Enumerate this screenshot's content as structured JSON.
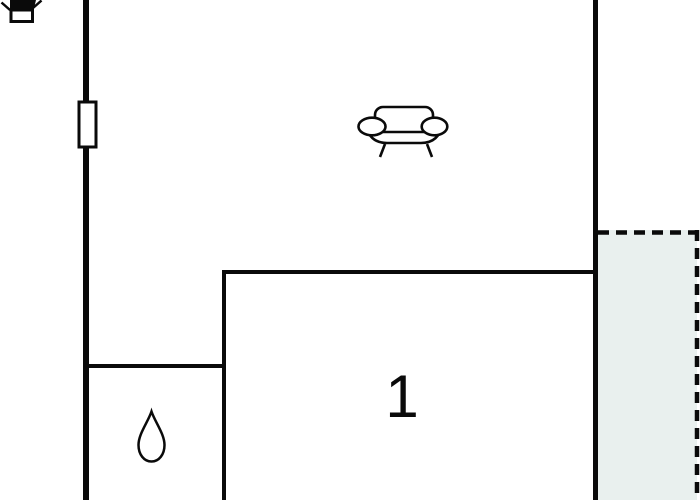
{
  "floorplan": {
    "rooms": {
      "room1": {
        "label": "1"
      }
    },
    "icons": {
      "stove": "stove-icon",
      "sofa": "sofa-icon",
      "water_drop": "water-drop-icon",
      "window": "window-icon"
    },
    "colors": {
      "wall": "#0a0a0a",
      "terrace_fill": "#e9f0ee",
      "water_drop_fill": "#b0f4f6",
      "background": "#ffffff"
    }
  }
}
